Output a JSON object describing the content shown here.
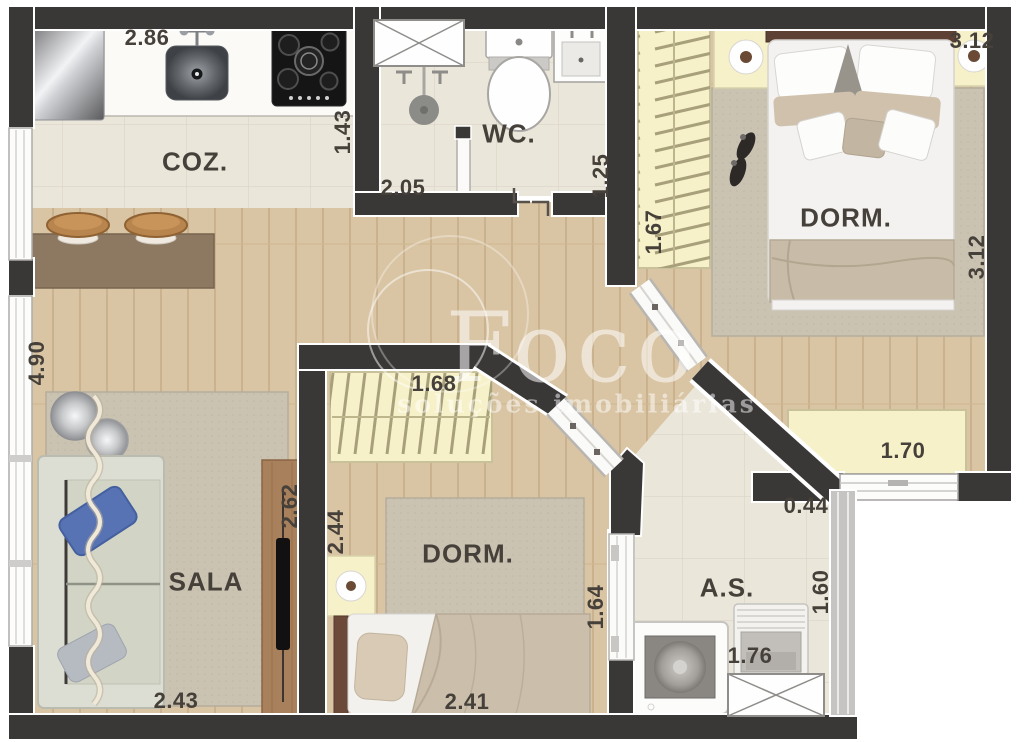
{
  "watermark": {
    "brand": "Foco",
    "tagline": "soluções imobiliárias"
  },
  "rooms": {
    "kitchen": {
      "label": "COZ.",
      "width": "2.86",
      "depth": "1.43"
    },
    "bathroom": {
      "label": "WC.",
      "shower_width": "2.05",
      "depth": "1.25"
    },
    "bedroom1": {
      "label": "DORM.",
      "width_top": "3.12",
      "depth": "3.12",
      "closet_depth": "1.67",
      "wardrobe_width": "1.70"
    },
    "living": {
      "label": "SALA",
      "depth": "4.90",
      "width": "2.43",
      "tv_wall": "2.62"
    },
    "bedroom2": {
      "label": "DORM.",
      "closet_width": "1.68",
      "depth": "2.44",
      "width": "2.41",
      "side": "1.64"
    },
    "service": {
      "label": "A.S.",
      "passage": "0.44",
      "depth": "1.60",
      "width": "1.76"
    }
  },
  "colors": {
    "wall": "#3a3737",
    "wood_floor": "#d9c4a3",
    "tile_floor": "#ebe6da",
    "closet": "#f7f1c9",
    "rug": "#cbc3b2",
    "label_text": "#46403a"
  }
}
